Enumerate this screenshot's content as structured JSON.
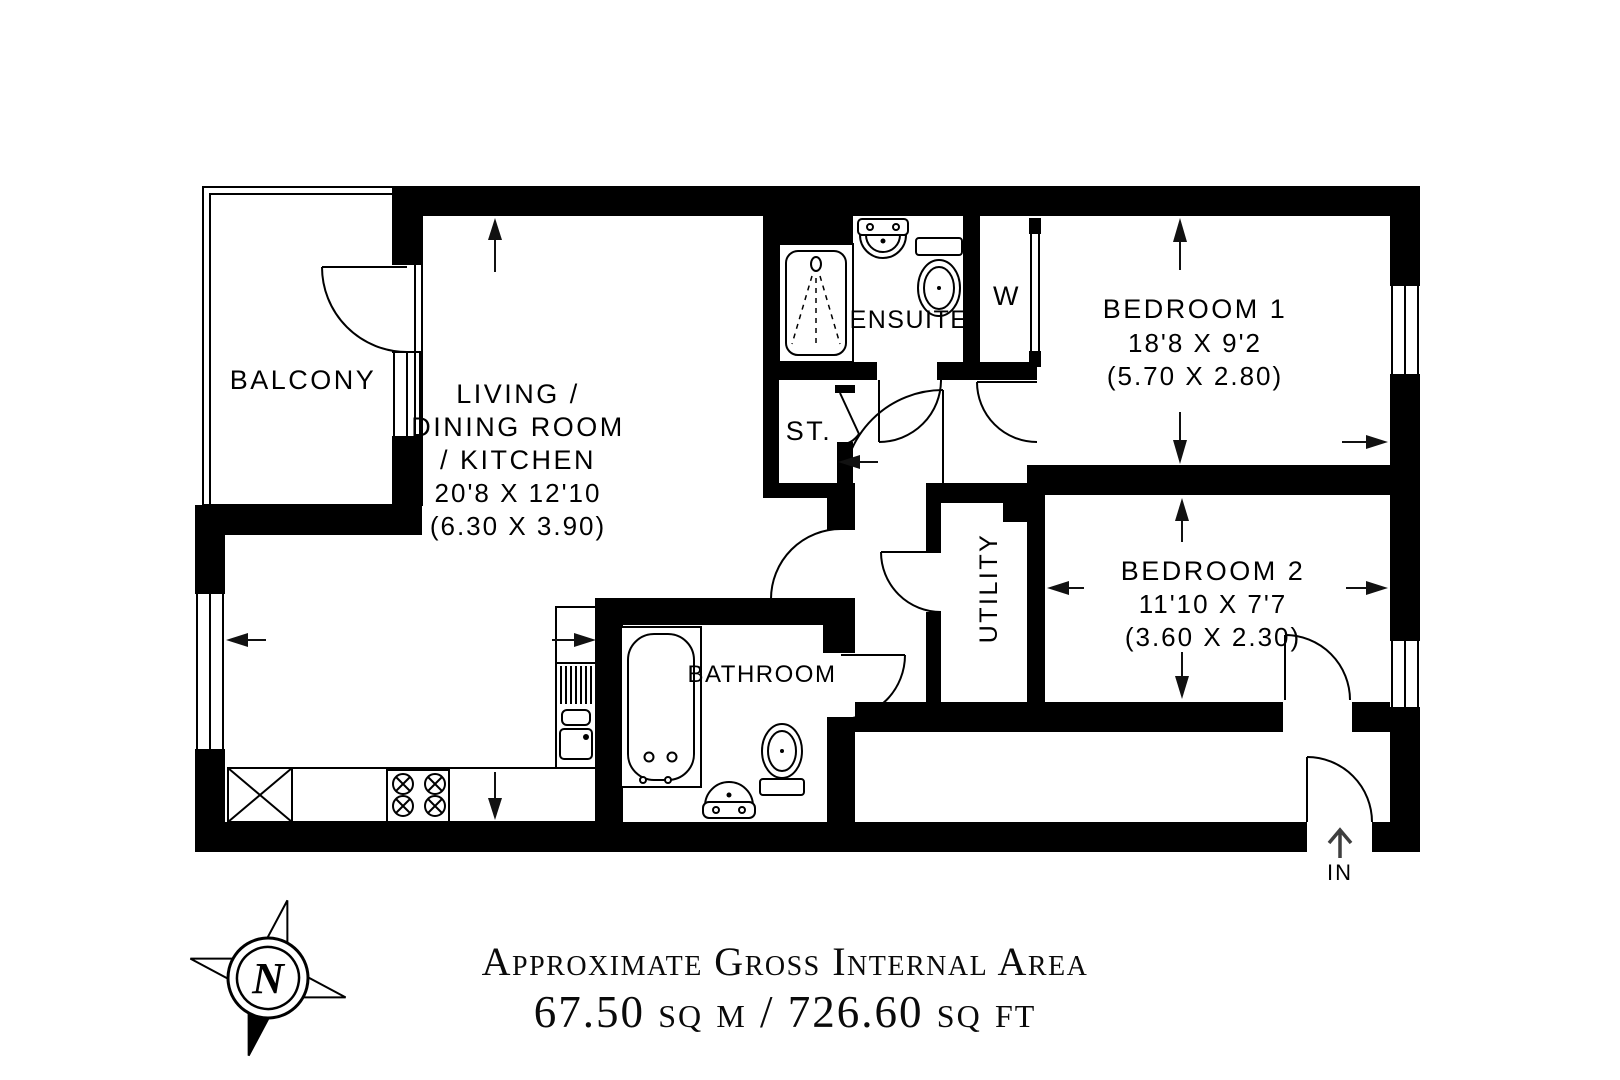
{
  "colors": {
    "ink": "#000000",
    "paper": "#ffffff",
    "entry_arrow_gray": "#3f3f3f"
  },
  "floor_plan": {
    "rooms": {
      "balcony": {
        "label": "BALCONY"
      },
      "living_dining_kitchen": {
        "line1": "LIVING /",
        "line2": "DINING ROOM",
        "line3": "/ KITCHEN",
        "dims_imperial": "20'8 X 12'10",
        "dims_metric": "(6.30 X 3.90)"
      },
      "ensuite": {
        "label": "ENSUITE"
      },
      "wardrobe": {
        "label": "W"
      },
      "bedroom1": {
        "label": "BEDROOM 1",
        "dims_imperial": "18'8 X 9'2",
        "dims_metric": "(5.70 X 2.80)"
      },
      "storage": {
        "label": "ST."
      },
      "utility": {
        "label": "UTILITY"
      },
      "bedroom2": {
        "label": "BEDROOM 2",
        "dims_imperial": "11'10 X 7'7",
        "dims_metric": "(3.60 X 2.30)"
      },
      "bathroom": {
        "label": "BATHROOM"
      }
    },
    "entrance": {
      "label": "IN"
    },
    "compass": {
      "label": "N"
    }
  },
  "footer": {
    "title": "Approximate Gross Internal Area",
    "area": "67.50 sq m / 726.60 sq ft"
  }
}
